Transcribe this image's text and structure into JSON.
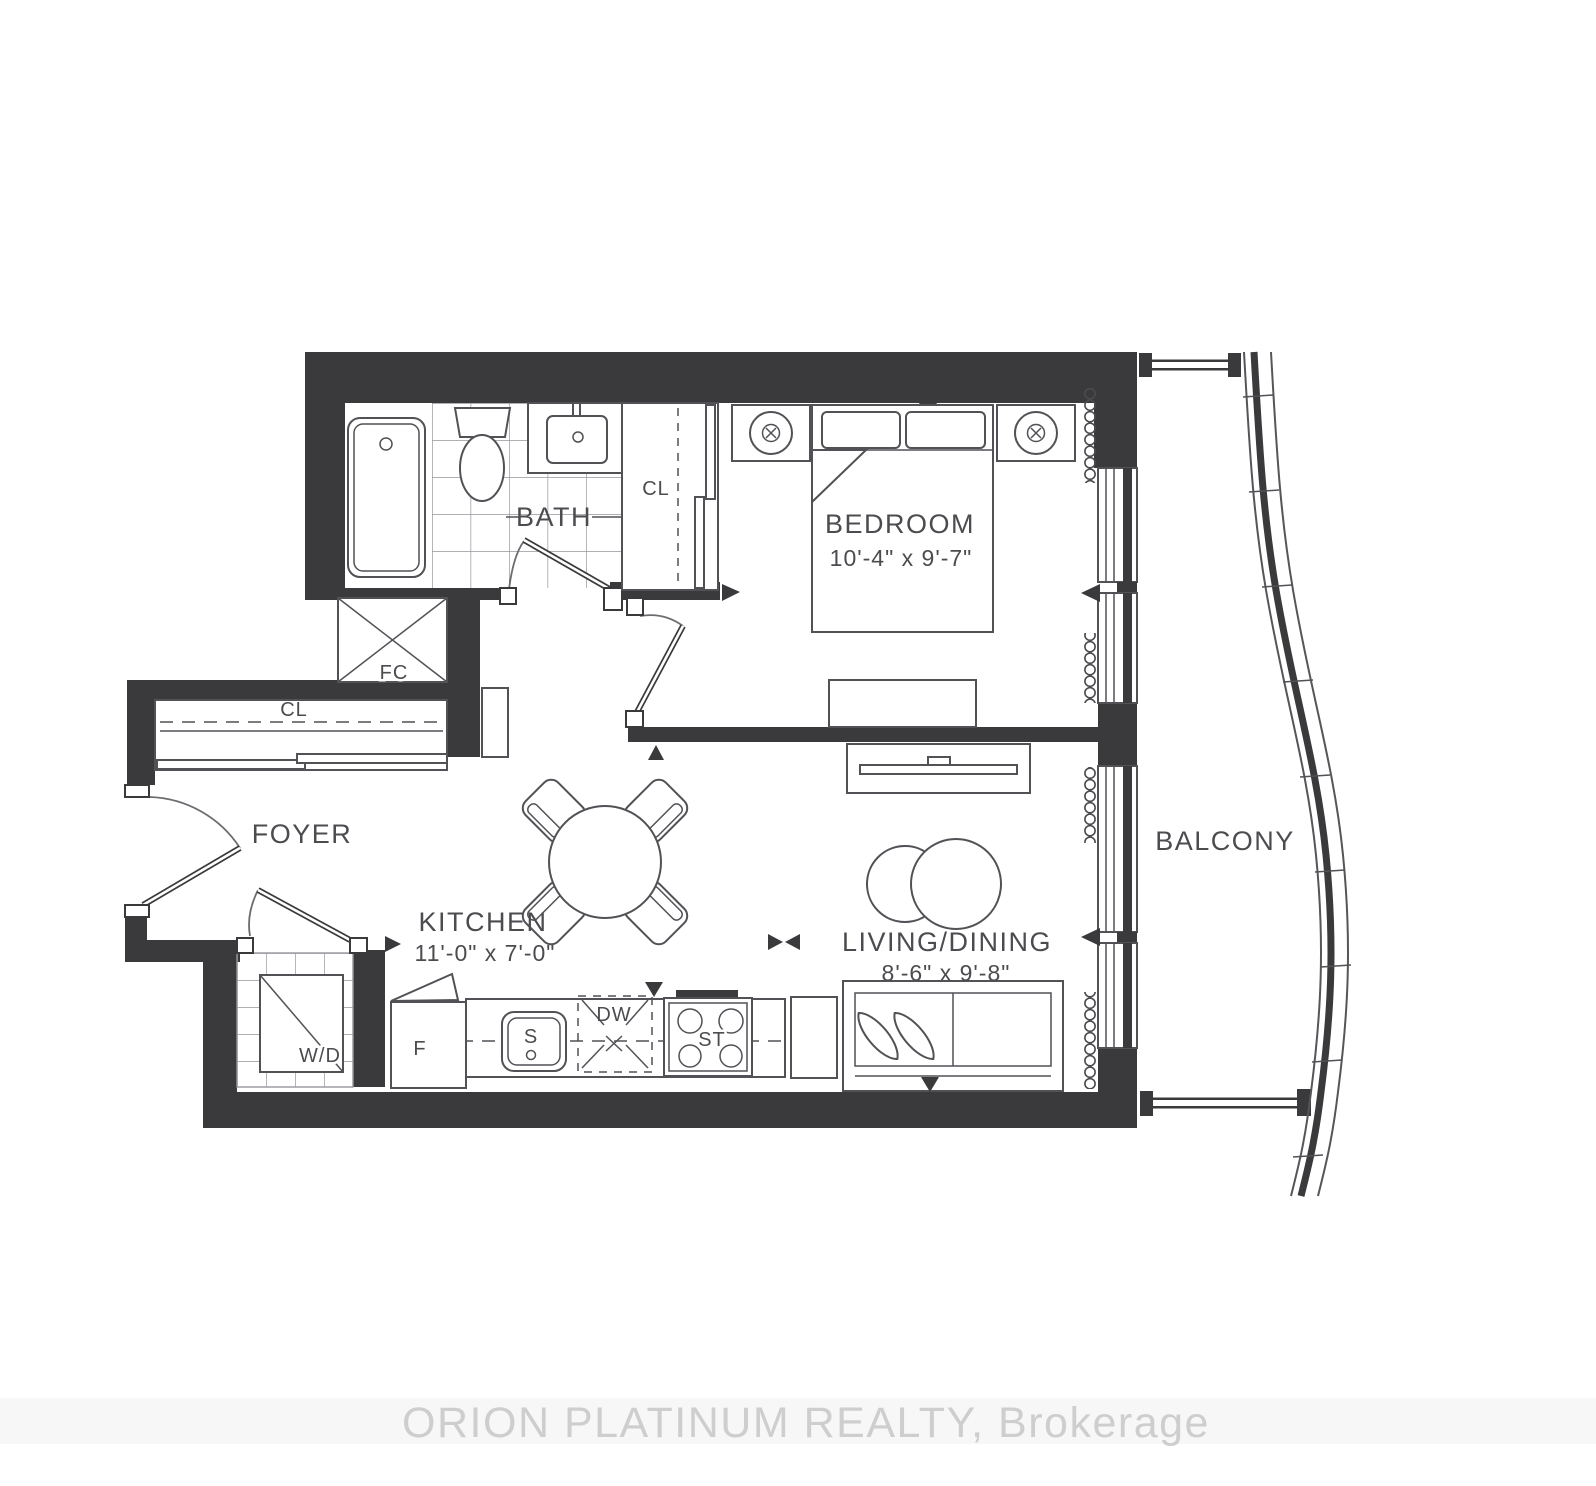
{
  "watermark": {
    "text": "ORION PLATINUM REALTY, Brokerage"
  },
  "rooms": {
    "bath": {
      "label": "BATH"
    },
    "bedroom": {
      "label": "BEDROOM",
      "dims": "10'-4\" x 9'-7\""
    },
    "kitchen": {
      "label": "KITCHEN",
      "dims": "11'-0\" x 7'-0\""
    },
    "living_dining": {
      "label": "LIVING/DINING",
      "dims": "8'-6\" x 9'-8\""
    },
    "foyer": {
      "label": "FOYER"
    },
    "balcony": {
      "label": "BALCONY"
    },
    "bedroom_closet": {
      "label": "CL"
    },
    "foyer_closet": {
      "label": "CL"
    },
    "front_closet": {
      "label": "FC"
    },
    "laundry": {
      "label": "W/D"
    }
  },
  "appliances": {
    "fridge": "F",
    "sink": "S",
    "dishwasher": "DW",
    "stove": "ST"
  },
  "colors": {
    "wall": "#3a3a3c",
    "line": "#515156",
    "text": "#4c4c50",
    "watermark": "#cccccc"
  }
}
